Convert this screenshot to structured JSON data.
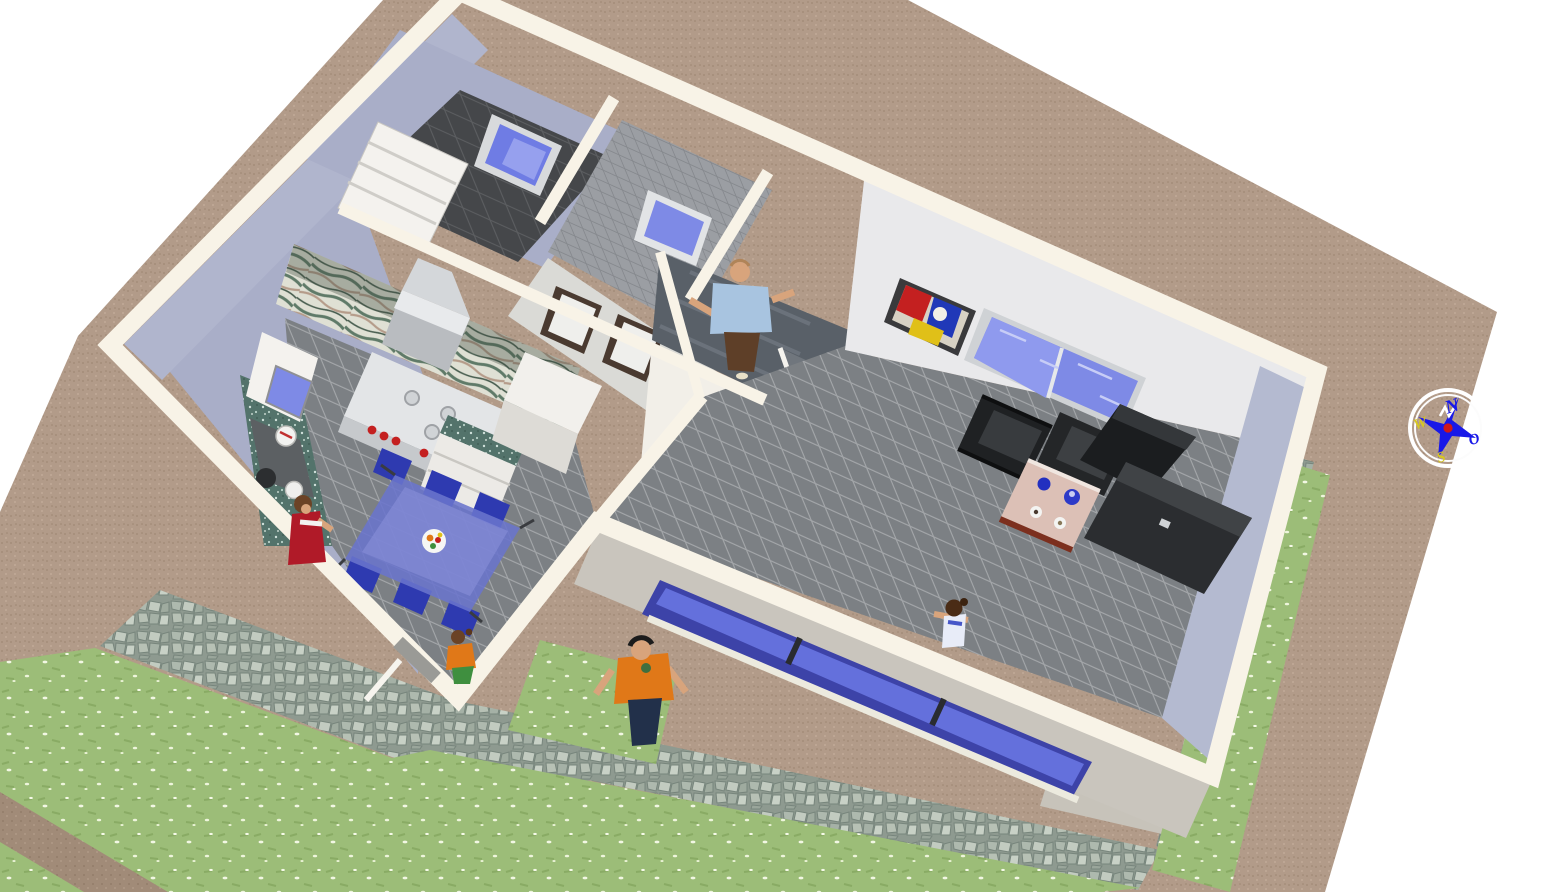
{
  "view": {
    "kind": "aerial-3d-home-walkthrough-render",
    "background_color": "#ffffff"
  },
  "palette": {
    "terrain_sand": "#b29b89",
    "wall_band_cream": "#f8f3e7",
    "wall_lavender": "#a9aec8",
    "wall_light_gray": "#e9e9eb",
    "floor_tile_gray": "#7c8084",
    "dark_tile": "#45474a",
    "marble_wall_green": "#6b7d6e",
    "granite_counter": "#53736b",
    "glass_blue": "#7e8ae6",
    "grass_green": "#9cbd78",
    "cobblestone": "#9aa69b",
    "sofa_black": "#1f2123",
    "dining_set_blue": "#2e3ab0",
    "coffee_table_pink": "#dcc0b6",
    "stove_white": "#e3e5e7",
    "stove_knob_red": "#c42020"
  },
  "compass": {
    "letters": {
      "north": "N",
      "west": "W",
      "south": "S",
      "east": "O"
    },
    "star_color": "#1818e8",
    "center_dot_color": "#d01818",
    "letter_color_ns": "#1818e8",
    "letter_color_we": "#d8c820"
  },
  "scene": {
    "outdoor": {
      "ground": "sand terrain plot",
      "lawns": [
        "west lawn with white flowers",
        "south lawn with white flowers",
        "east lawn strip"
      ],
      "paths": [
        "cobblestone patio at kitchen door",
        "cobblestone path along south wall",
        "cobblestone path along east wall",
        "dirt strip across west lawn"
      ]
    },
    "house": {
      "rooms": [
        {
          "name": "bedroom",
          "floor": "dark tile",
          "furniture": [
            "white wardrobe shelves",
            "window with blue glass"
          ]
        },
        {
          "name": "bathroom",
          "floor": "gray tile walls and floor",
          "furniture": [
            "window with blue glass"
          ]
        },
        {
          "name": "hallway",
          "furniture": [
            "door with dark frame",
            "door with dark frame"
          ]
        },
        {
          "name": "kitchen",
          "floor": "gray tile",
          "furniture": [
            "marble tiled wall",
            "range hood",
            "stove with red knobs",
            "granite sink counter with dishes",
            "white cabinet",
            "tall white cupboard",
            "glass cabinet",
            "blue glass dining table",
            "six blue chairs",
            "fruit plate"
          ]
        },
        {
          "name": "staircase",
          "furniture": [
            "upper landing",
            "lower flight with white stringers"
          ]
        },
        {
          "name": "living-room",
          "floor": "gray tile",
          "furniture": [
            "abstract painting",
            "north window",
            "two black leather armchairs",
            "coffee table with cups and plates",
            "black tv",
            "black sideboard",
            "south triple window"
          ]
        },
        {
          "name": "west-room",
          "floor": "lavender",
          "furniture": [
            "white cabinet with glass front"
          ]
        }
      ]
    },
    "people": [
      {
        "id": "man-on-staircase",
        "shirt": "#a8c4e0",
        "pants": "#5e3f28"
      },
      {
        "id": "woman-at-counter",
        "dress": "#b01a28"
      },
      {
        "id": "child-at-kitchen-door",
        "top": "#e07818",
        "pants": "#3f8f3f"
      },
      {
        "id": "child-at-south-window",
        "top": "#e8ecf8"
      },
      {
        "id": "man-on-lawn",
        "shirt": "#e07818",
        "pants": "#22304a"
      }
    ]
  }
}
